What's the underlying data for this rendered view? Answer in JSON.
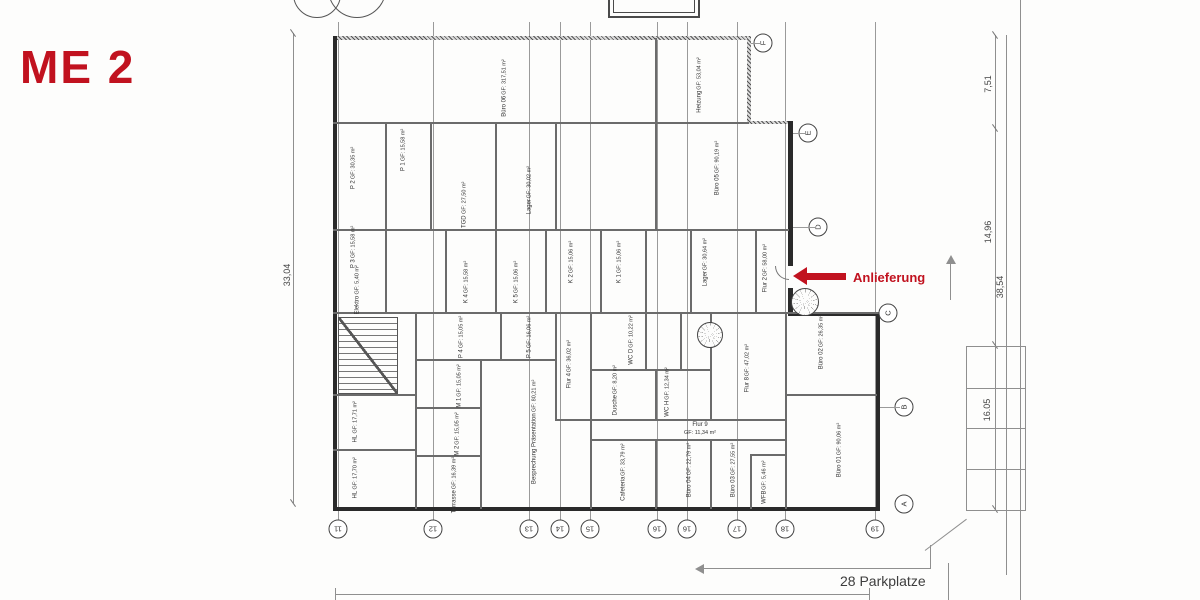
{
  "title": {
    "label": "ME 2",
    "color": "#c1121f"
  },
  "annotations": {
    "delivery": "Anlieferung",
    "parking": "28 Parkplatze",
    "accent_color": "#c1121f"
  },
  "dimensions": {
    "right_upper": "7,51",
    "right_mid": "14,96",
    "right_total": "38,54",
    "right_lower": "16.05",
    "left": "33,04"
  },
  "grid": {
    "letters": [
      "F",
      "E",
      "D",
      "C",
      "B",
      "A"
    ],
    "numbers": [
      "11",
      "12",
      "13",
      "14",
      "15",
      "16",
      "16",
      "17",
      "18",
      "19"
    ]
  },
  "rooms": [
    {
      "name": "Büro 06",
      "area": "GF: 317,51 m²"
    },
    {
      "name": "Heizung",
      "area": "GF: 53,04 m²"
    },
    {
      "name": "P 2",
      "area": "GF: 30,35 m²"
    },
    {
      "name": "P 1",
      "area": "GF: 15,58 m²"
    },
    {
      "name": "TGD",
      "area": "GF: 27,50 m²"
    },
    {
      "name": "Lager",
      "area": "GF: 30,02 m²"
    },
    {
      "name": "Büro 05",
      "area": "GF: 90,19 m²"
    },
    {
      "name": "P 3",
      "area": "GF: 15,58 m²"
    },
    {
      "name": "Elektro",
      "area": "GF: 5,40 m²"
    },
    {
      "name": "K 4",
      "area": "GF: 15,58 m²"
    },
    {
      "name": "K 5",
      "area": "GF: 15,06 m²"
    },
    {
      "name": "K 2",
      "area": "GF: 15,06 m²"
    },
    {
      "name": "K 1",
      "area": "GF: 15,06 m²"
    },
    {
      "name": "Lager",
      "area": "GF: 30,64 m²"
    },
    {
      "name": "Flur 2",
      "area": "GF: 58,00 m²"
    },
    {
      "name": "P 4",
      "area": "GF: 15,05 m²"
    },
    {
      "name": "P 5",
      "area": "GF: 16,06 m²"
    },
    {
      "name": "M 1",
      "area": "GF: 15,05 m²"
    },
    {
      "name": "M 2",
      "area": "GF: 15,05 m²"
    },
    {
      "name": "Terrasse",
      "area": "GF: 16,39 m²"
    },
    {
      "name": "HL",
      "area": "GF: 17,71 m²"
    },
    {
      "name": "HL",
      "area": "GF: 17,70 m²"
    },
    {
      "name": "Besprechung Präsentation",
      "area": "GF: 80,21 m²"
    },
    {
      "name": "Flur 4",
      "area": "GF: 36,02 m²"
    },
    {
      "name": "WC D",
      "area": "GF: 10,22 m²"
    },
    {
      "name": "WC H",
      "area": "GF: 12,34 m²"
    },
    {
      "name": "Dusche",
      "area": "GF: 8,20 m²"
    },
    {
      "name": "Flur 8",
      "area": "GF: 47,02 m²"
    },
    {
      "name": "Flur 9",
      "area": "GF: 11,34 m²"
    },
    {
      "name": "Cafeteria",
      "area": "GF: 33,79 m²"
    },
    {
      "name": "Büro 04",
      "area": "GF: 22,79 m²"
    },
    {
      "name": "Büro 03",
      "area": "GF: 27,55 m²"
    },
    {
      "name": "WFB",
      "area": "GF: 5,46 m²"
    },
    {
      "name": "Büro 01",
      "area": "GF: 90,06 m²"
    },
    {
      "name": "Büro 02",
      "area": "GF: 26,35 m²"
    }
  ]
}
